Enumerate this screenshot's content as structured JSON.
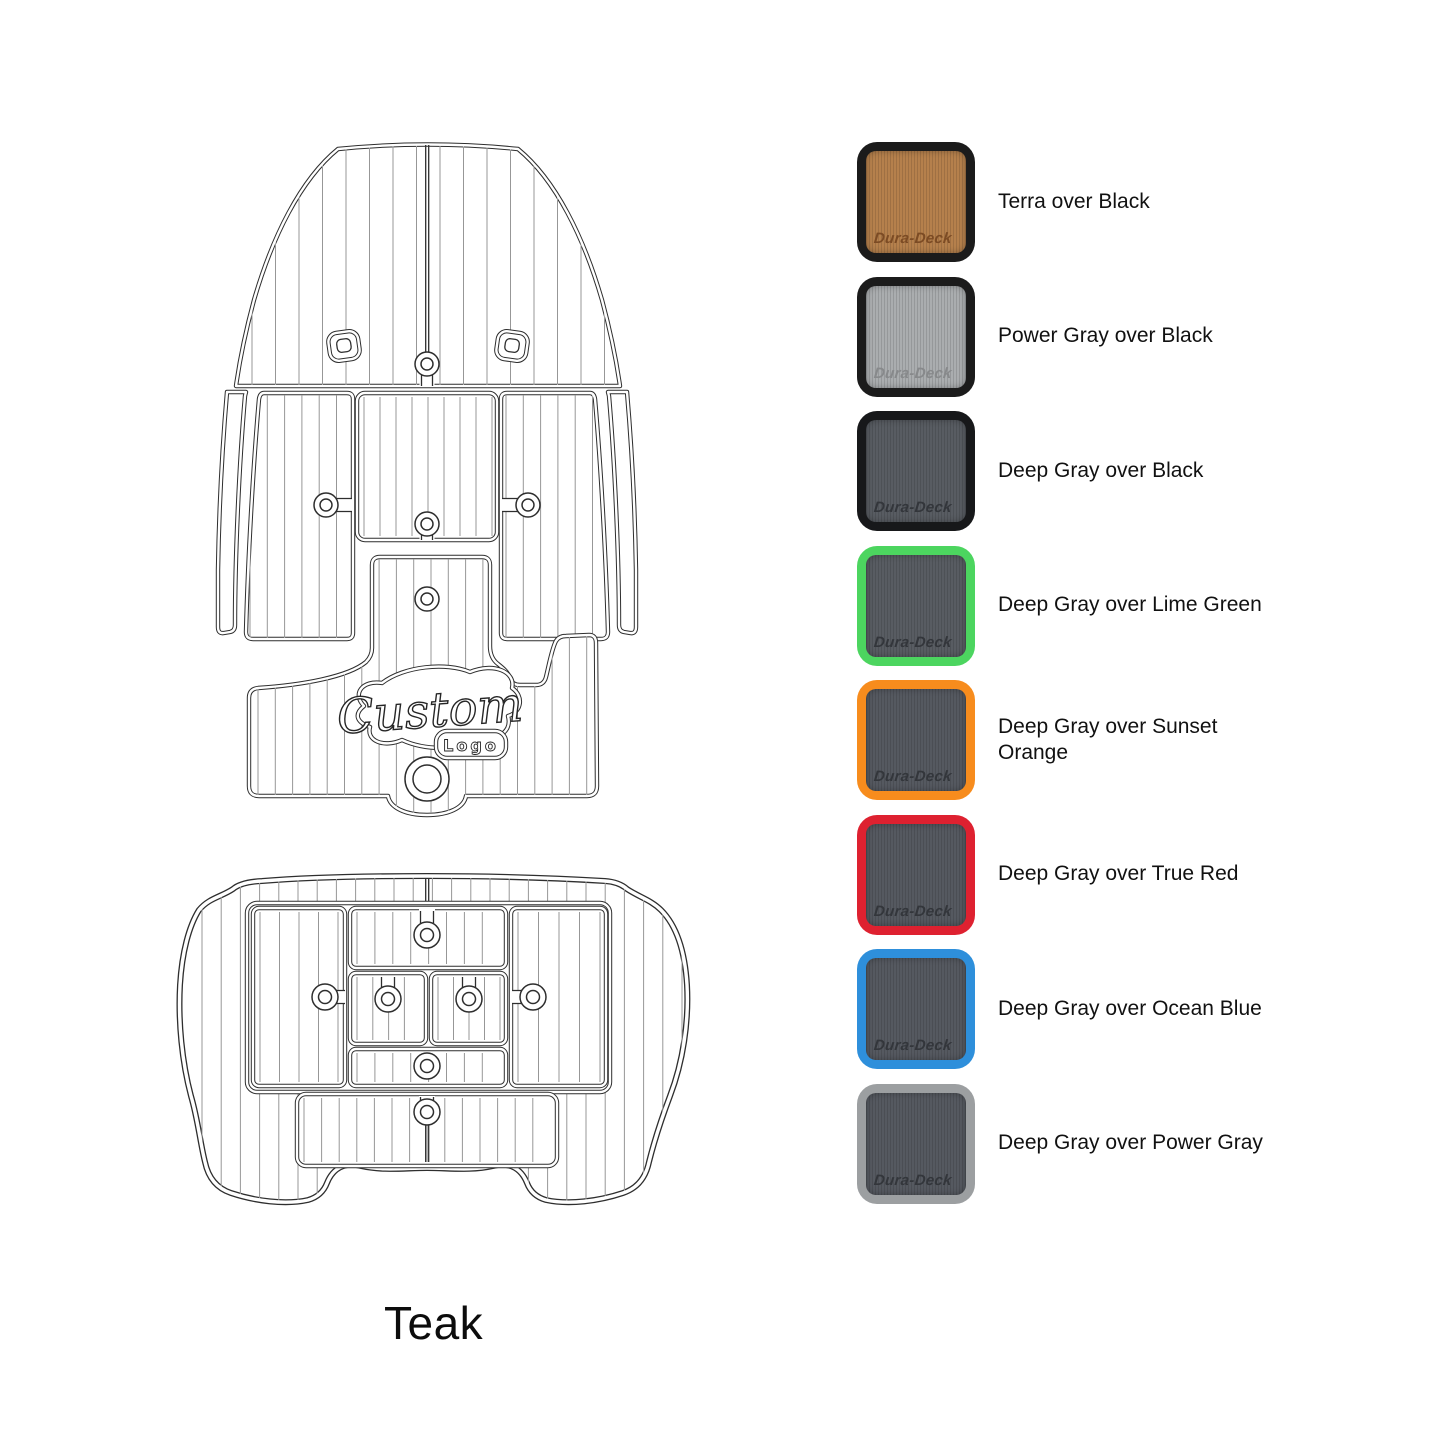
{
  "page": {
    "background_color": "#ffffff"
  },
  "drawing": {
    "material_label": "Teak",
    "custom_logo": {
      "line1": "Custom",
      "line2": "Logo"
    },
    "line_color": "#2e2e2e"
  },
  "swatches": {
    "brand": "Dura-Deck",
    "items": [
      {
        "label": "Terra over Black",
        "pad_color": "#b5804c",
        "border_color": "#1b1b1b",
        "brand_color": "#7c4b24"
      },
      {
        "label": "Power Gray over Black",
        "pad_color": "#aaadaf",
        "border_color": "#1b1b1b",
        "brand_color": "#87898b"
      },
      {
        "label": "Deep Gray over Black",
        "pad_color": "#585c62",
        "border_color": "#17181a",
        "brand_color": "#33363b"
      },
      {
        "label": "Deep Gray over Lime Green",
        "pad_color": "#585c62",
        "border_color": "#4cd55f",
        "brand_color": "#33363b"
      },
      {
        "label": "Deep Gray over Sunset Orange",
        "pad_color": "#555960",
        "border_color": "#f78c1d",
        "brand_color": "#33363b"
      },
      {
        "label": "Deep Gray over True Red",
        "pad_color": "#555960",
        "border_color": "#de2130",
        "brand_color": "#33363b"
      },
      {
        "label": "Deep Gray over Ocean Blue",
        "pad_color": "#555960",
        "border_color": "#2e8fdb",
        "brand_color": "#33363b"
      },
      {
        "label": "Deep Gray over Power Gray",
        "pad_color": "#555960",
        "border_color": "#9c9fa1",
        "brand_color": "#33363b"
      }
    ]
  }
}
